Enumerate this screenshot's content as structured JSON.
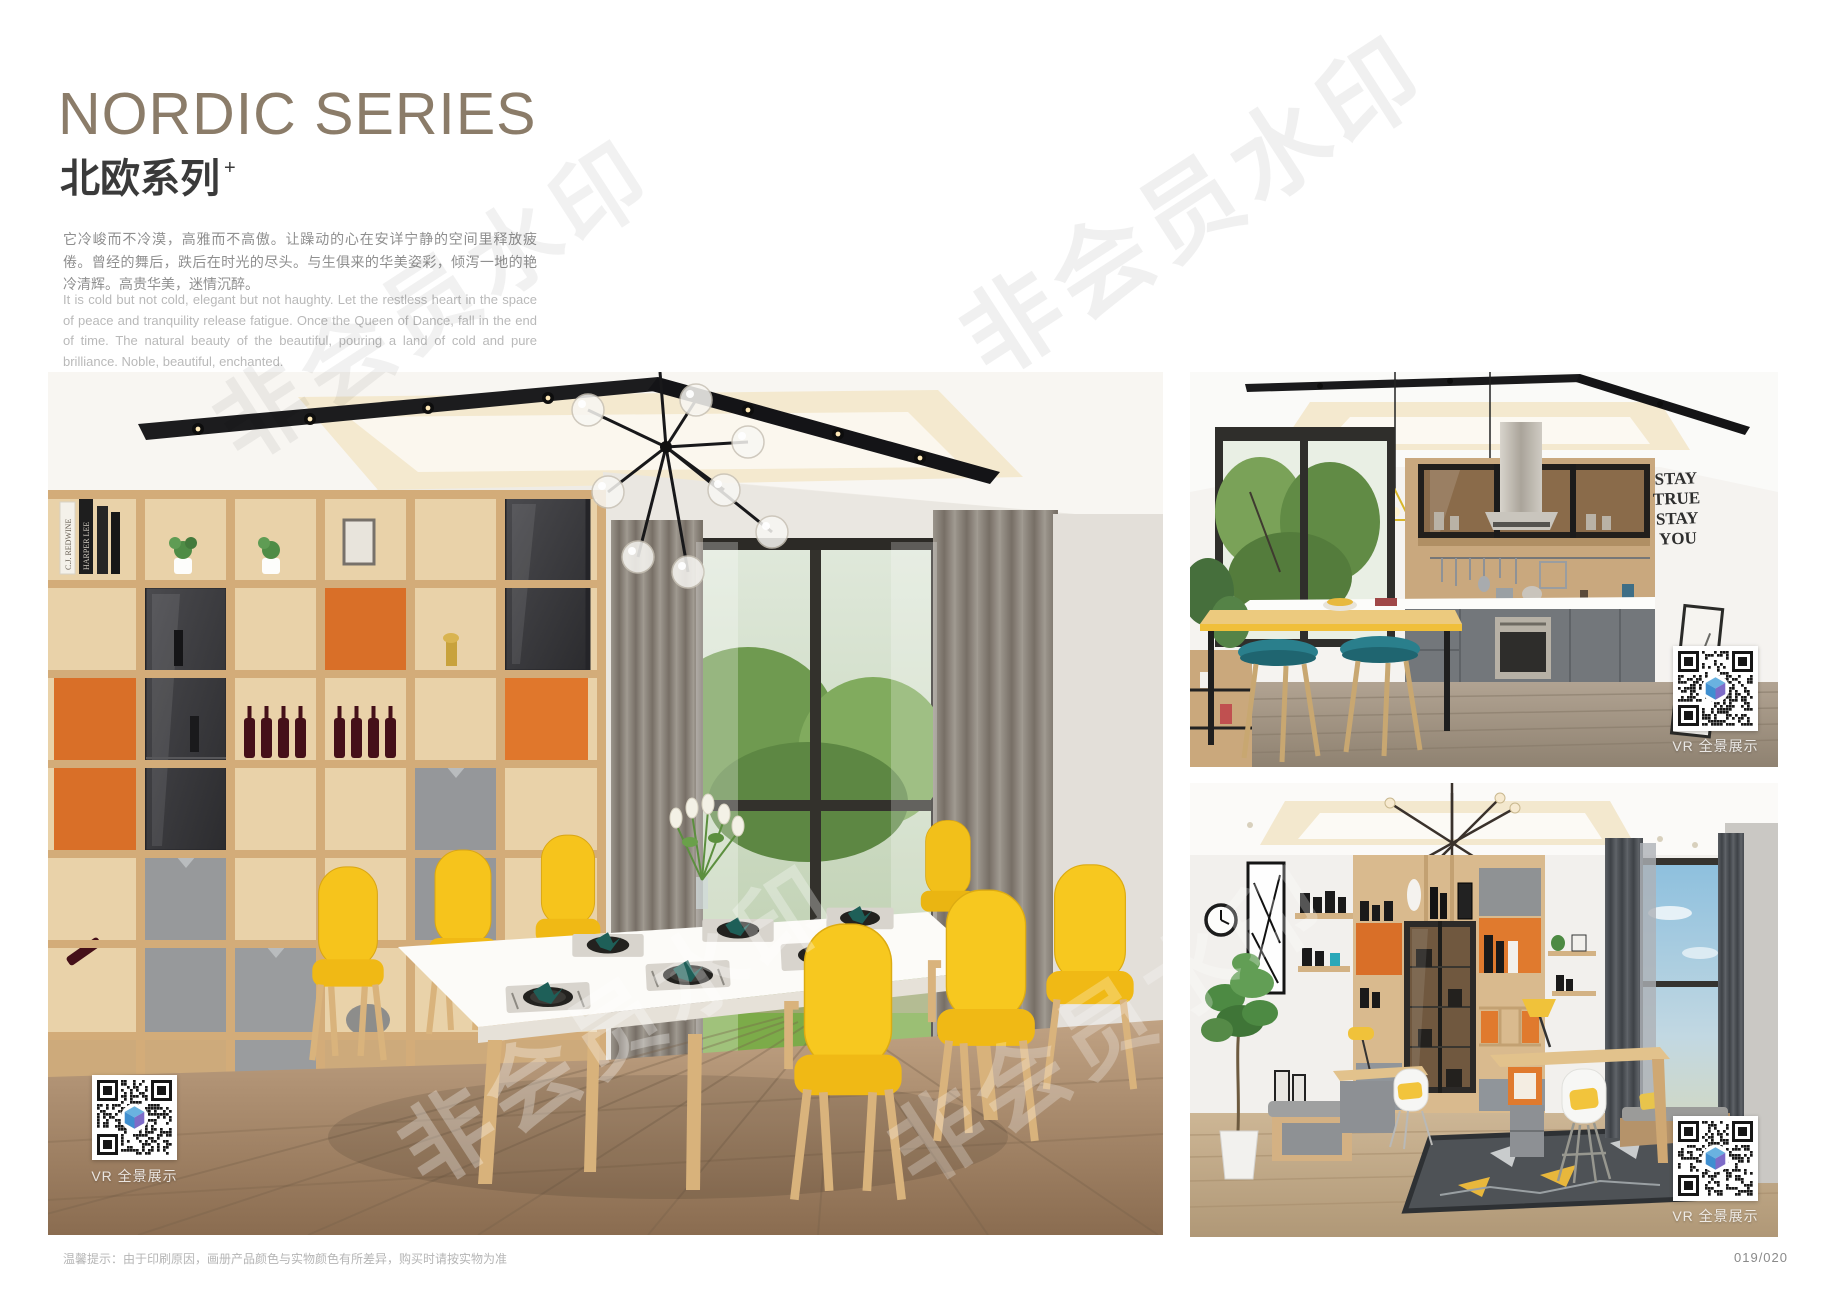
{
  "header": {
    "title_en": "NORDIC SERIES",
    "title_zh": "北欧系列",
    "title_sup": "+",
    "desc_zh": "它冷峻而不冷漠，高雅而不高傲。让躁动的心在安详宁静的空间里释放疲倦。曾经的舞后，跌后在时光的尽头。与生俱来的华美姿彩，倾泻一地的艳冷清辉。高贵华美，迷情沉醉。",
    "desc_en": "It is cold but not cold, elegant but not haughty. Let the restless heart in the space of peace and tranquility release fatigue. Once the Queen of Dance, fall in the end of time. The natural beauty of the beautiful, pouring a land of cold and pure brilliance. Noble, beautiful, enchanted."
  },
  "watermark": {
    "text": "非会员水印"
  },
  "vr_label": "VR 全景展示",
  "photos": {
    "dining": {
      "book_spines": [
        "C.J. REDWINE",
        "HARPER LEE"
      ]
    },
    "kitchen": {
      "wall_art": [
        "STAY",
        "TRUE",
        "STAY",
        "YOU"
      ]
    }
  },
  "footer": {
    "note": "温馨提示：由于印刷原因，画册产品颜色与实物颜色有所差异，购买时请按实物为准",
    "page_number": "019/020"
  },
  "colors": {
    "title_tan": "#8b7c69",
    "accent_orange": "#d96f28",
    "chair_yellow": "#f5c51e",
    "napkin_teal": "#1e5f58",
    "stool_teal": "#2a7f8c"
  }
}
